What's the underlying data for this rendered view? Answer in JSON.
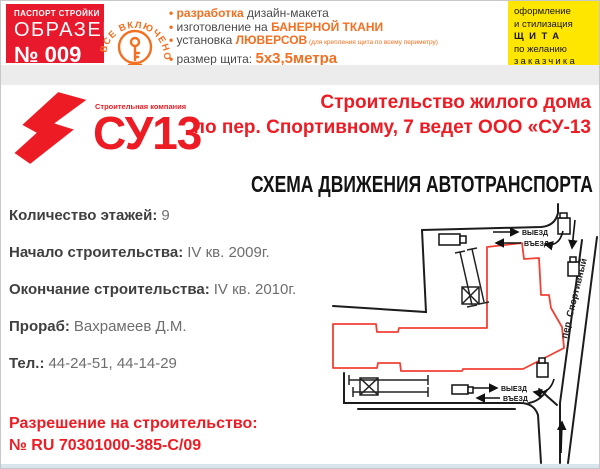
{
  "header": {
    "passport": {
      "top": "ПАСПОРТ СТРОЙКИ",
      "middle": "ОБРАЗЕЦ",
      "number": "№ 009"
    },
    "badge": {
      "text": "ВСЕ ВКЛЮЧЕНО"
    },
    "features": {
      "f1": {
        "a": "разработка",
        "b": " дизайн-макета"
      },
      "f2": {
        "a": "изготовление на ",
        "b": "БАНЕРНОЙ ТКАНИ"
      },
      "f3": {
        "a": "установка ",
        "b": "ЛЮВЕРСОВ",
        "c": " (для крепления щита по всему периметру)"
      },
      "f4": {
        "a": "размер щита: ",
        "b": "5х3,5метра"
      }
    },
    "offer": {
      "l1": "оформление",
      "l2": "и стилизация",
      "l3": "ЩИТА",
      "l4": "по желанию",
      "l5": "заказчика"
    }
  },
  "logo": {
    "company": "Строительная компания",
    "name": "СУ13"
  },
  "title": {
    "line1": "Строительство жилого дома",
    "line2": "по пер. Спортивному, 7 ведет ООО «СУ-13"
  },
  "map": {
    "title": "СХЕМА ДВИЖЕНИЯ АВТОТРАНСПОРТА",
    "street": "пер. Спортивный",
    "exit": "ВЫЕЗД",
    "entry": "ВЪЕЗД"
  },
  "info": {
    "items": [
      {
        "label": "Количество этажей:",
        "value": "9"
      },
      {
        "label": "Начало строительства:",
        "value": "IV кв. 2009г."
      },
      {
        "label": "Окончание строительства:",
        "value": "IV кв. 2010г."
      },
      {
        "label": "Прораб:",
        "value": "Вахрамеев Д.М."
      },
      {
        "label": "Тел.:",
        "value": "44-24-51, 44-14-29"
      }
    ]
  },
  "permit": {
    "line1": "Разрешение на строительство:",
    "line2": "№ RU 70301000-385-С/09"
  },
  "colors": {
    "red": "#ed1c24",
    "orange": "#f36f21",
    "yellow": "#ffe600",
    "dark_text": "#3f3f3f",
    "map_black": "#1a1a1a",
    "building_red": "#f04134"
  }
}
